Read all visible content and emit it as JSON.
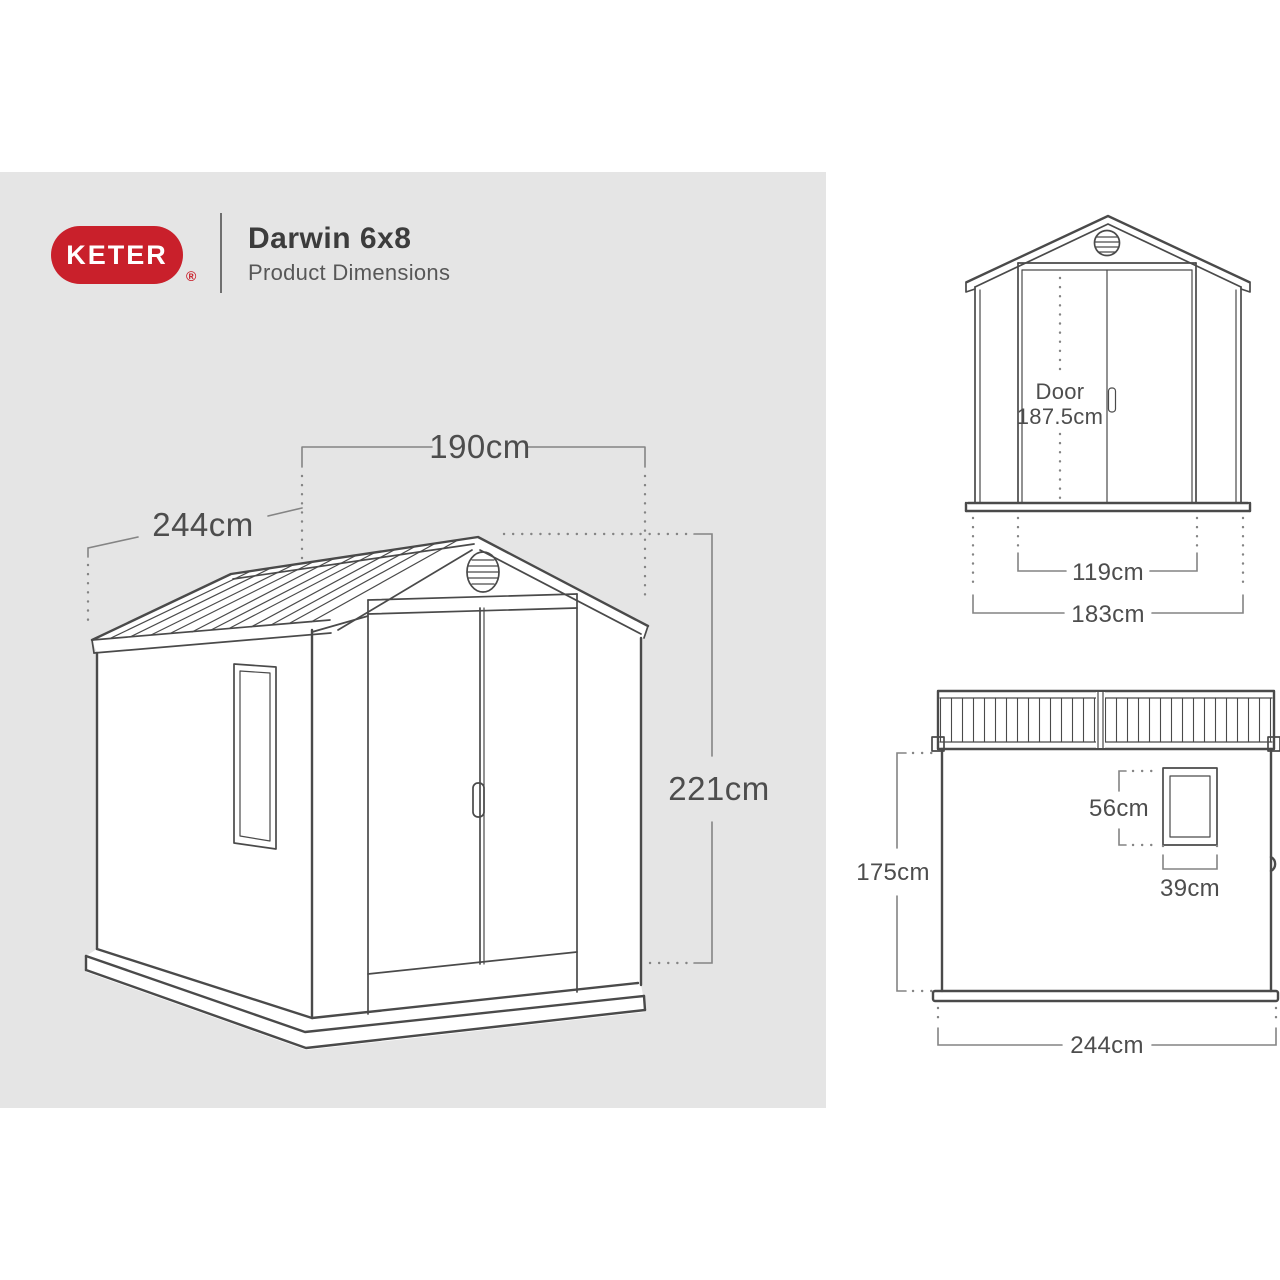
{
  "header": {
    "brand": "KETER",
    "registered_mark": "®",
    "product_title": "Darwin 6x8",
    "subtitle": "Product Dimensions"
  },
  "colors": {
    "brand_red": "#c9202b",
    "panel_gray": "#e5e5e5",
    "drawing_line": "#4a4a4a",
    "dimension_line": "#848484",
    "text": "#4d4d4d"
  },
  "perspective_view": {
    "width_label": "190cm",
    "depth_label": "244cm",
    "height_label": "221cm"
  },
  "front_view": {
    "door_label": "Door",
    "door_height_label": "187.5cm",
    "door_width_label": "119cm",
    "overall_width_label": "183cm"
  },
  "side_view": {
    "window_height_label": "56cm",
    "window_width_label": "39cm",
    "wall_height_label": "175cm",
    "depth_label": "244cm"
  }
}
